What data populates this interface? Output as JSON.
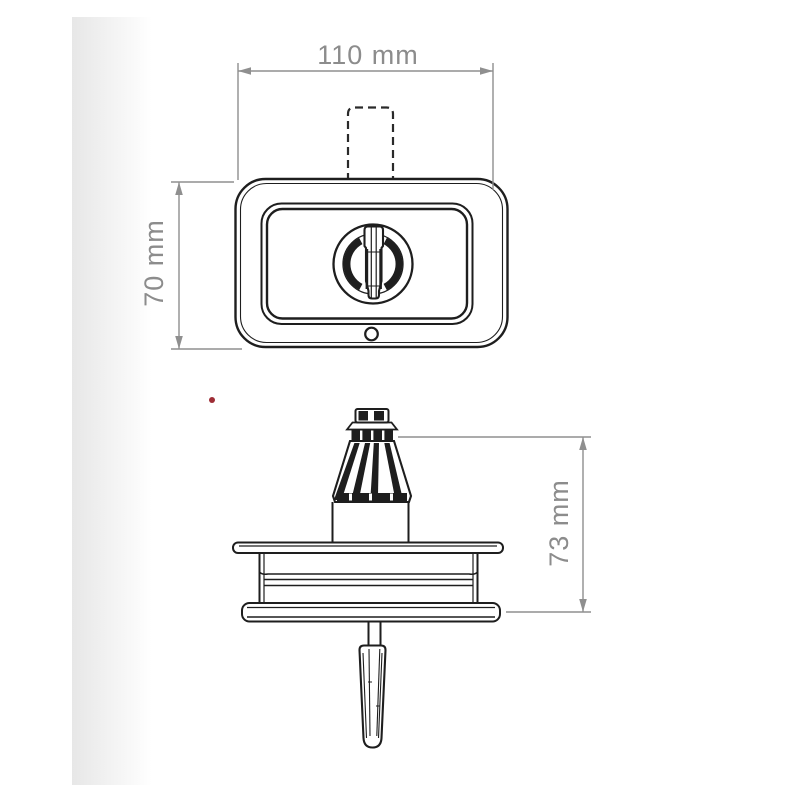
{
  "drawing": {
    "front_view": {
      "width_dim": {
        "label": "110 mm"
      },
      "height_dim": {
        "label": "70 mm"
      }
    },
    "side_view": {
      "height_dim": {
        "label": "73 mm"
      }
    }
  },
  "colors": {
    "line": "#1e1e1e",
    "dimension_line": "#8f8f8f",
    "dimension_text": "#8c8c8c",
    "red_dot": "#9e2d35",
    "page_shadow": "#e7e7e7",
    "background": "#ffffff"
  }
}
